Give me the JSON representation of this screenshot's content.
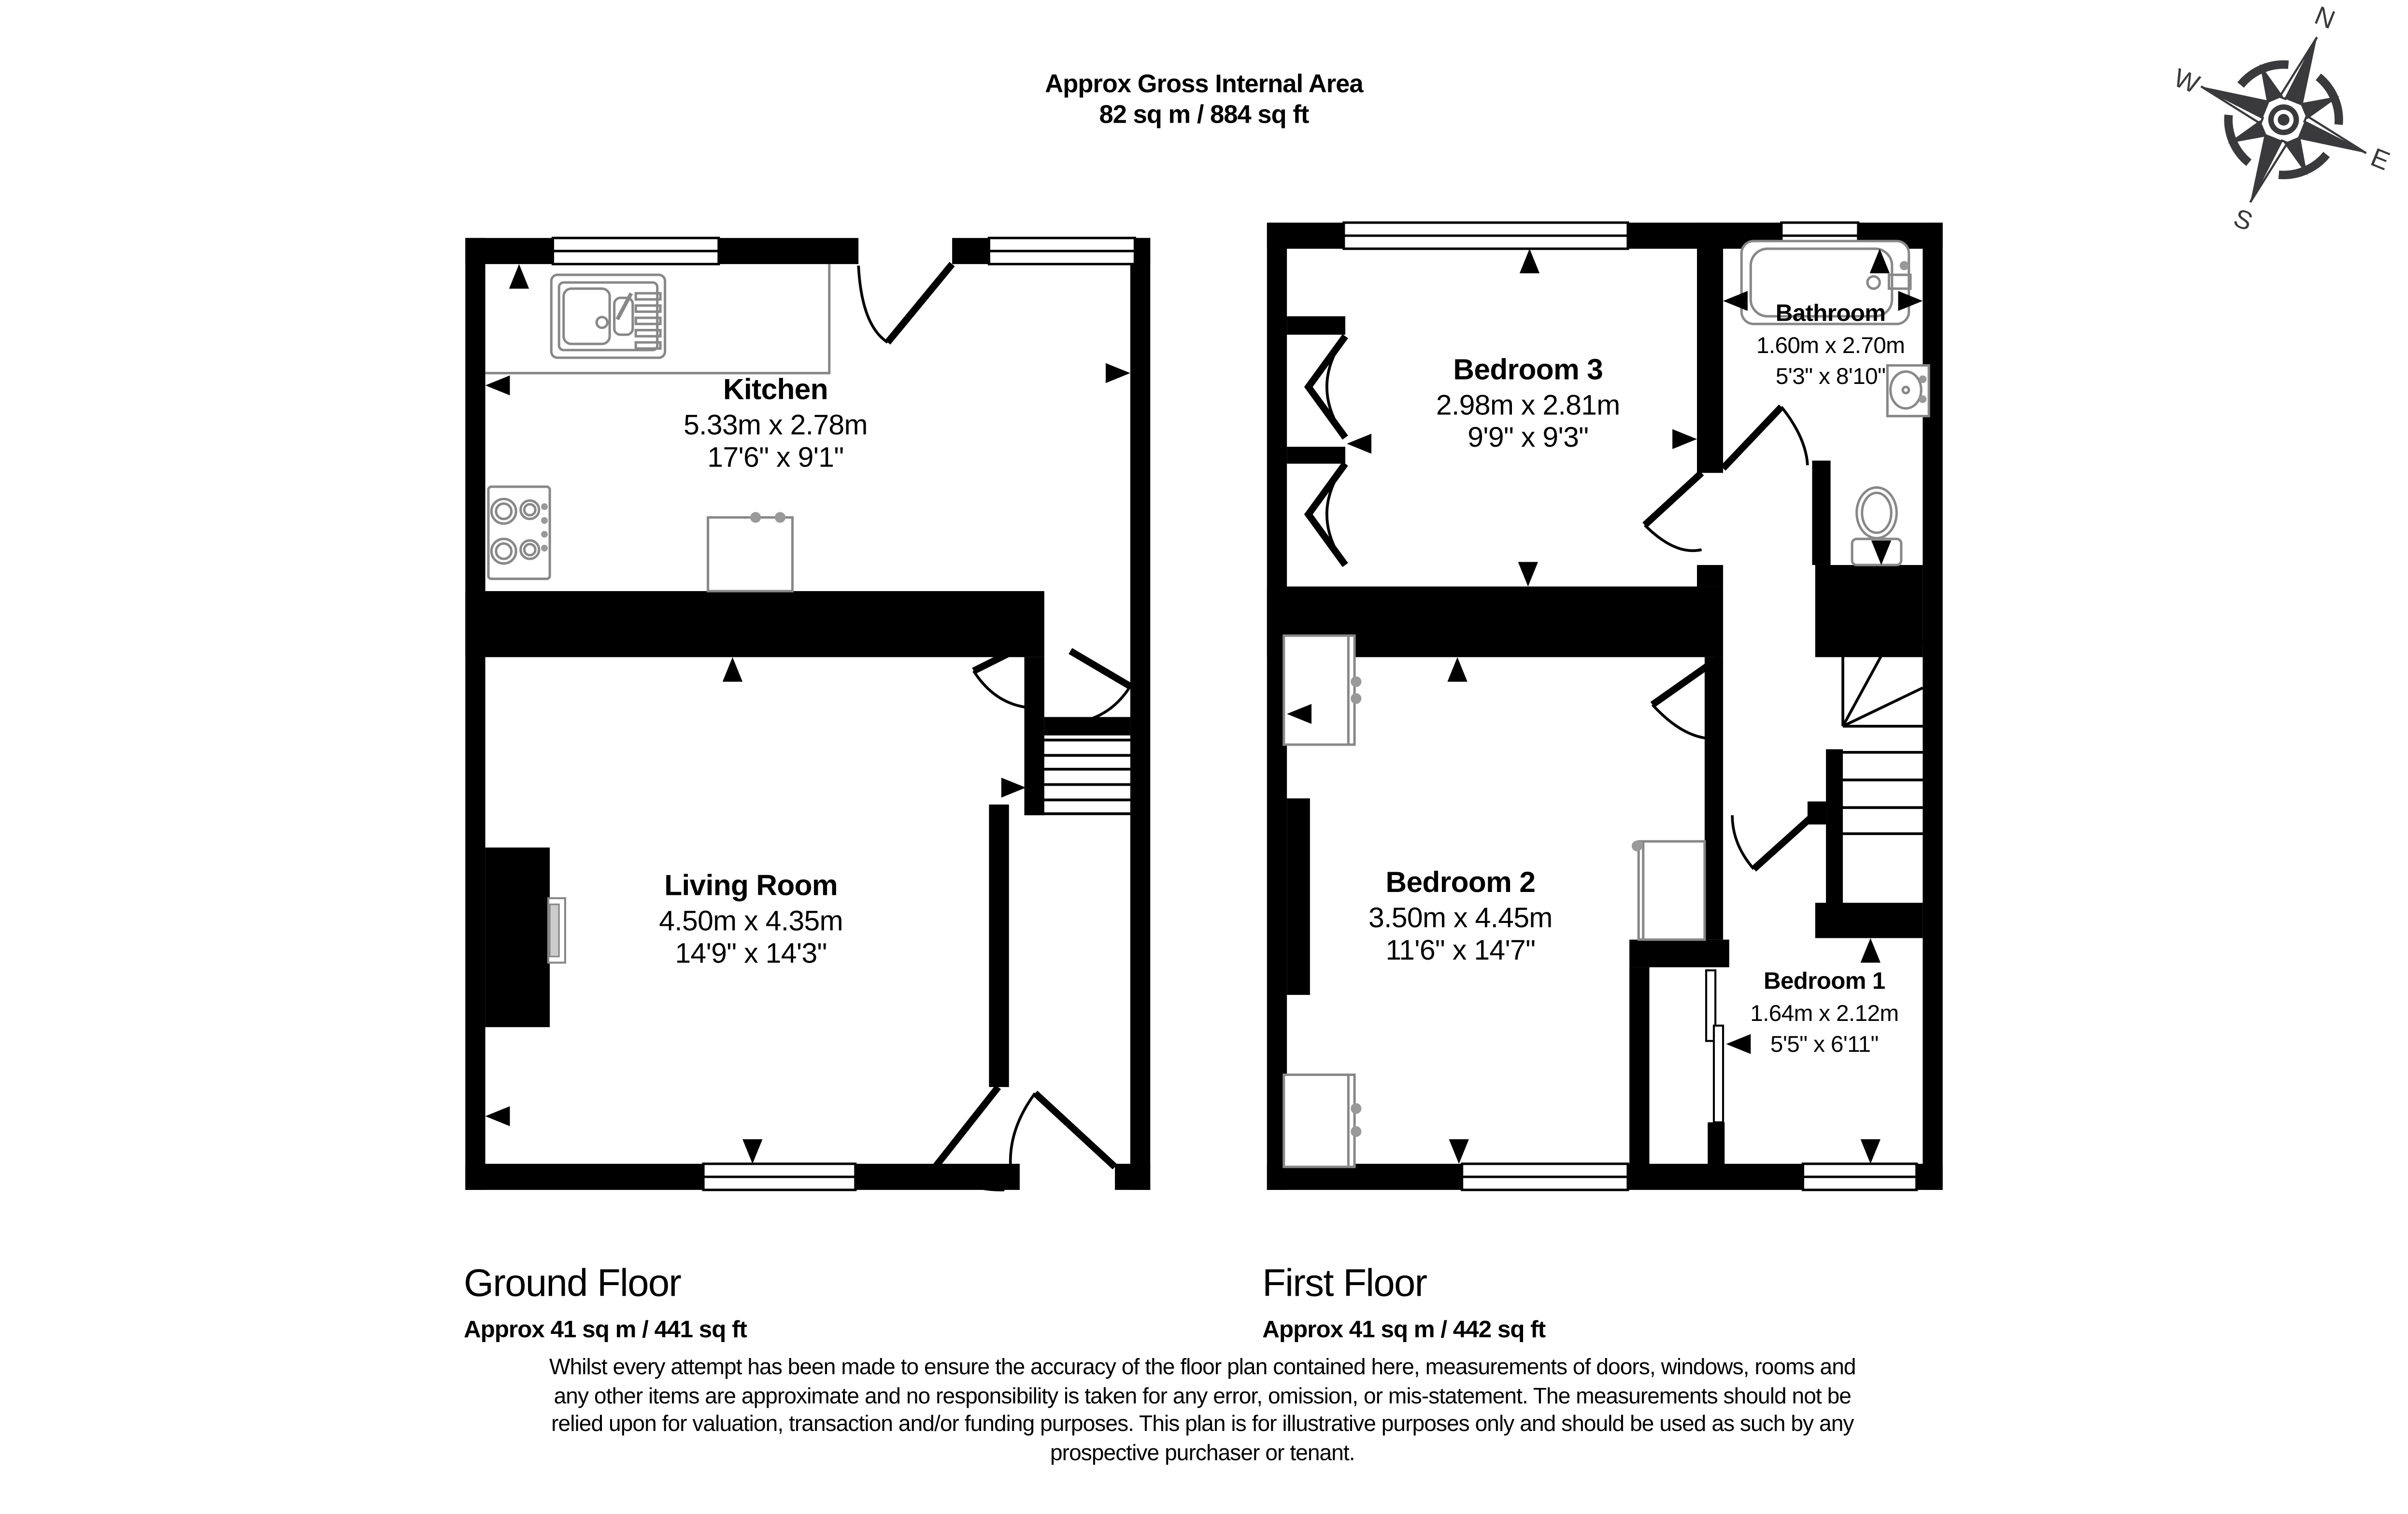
{
  "header": {
    "line1": "Approx Gross Internal Area",
    "line2": "82 sq m / 884 sq ft"
  },
  "compass": {
    "n": "N",
    "e": "E",
    "s": "S",
    "w": "W"
  },
  "rooms": [
    {
      "id": "kitchen",
      "name": "Kitchen",
      "metric": "5.33m x 2.78m",
      "imperial": "17'6\" x 9'1\""
    },
    {
      "id": "living-room",
      "name": "Living Room",
      "metric": "4.50m x 4.35m",
      "imperial": "14'9\" x 14'3\""
    },
    {
      "id": "bedroom-3",
      "name": "Bedroom 3",
      "metric": "2.98m x 2.81m",
      "imperial": "9'9\" x 9'3\""
    },
    {
      "id": "bathroom",
      "name": "Bathroom",
      "metric": "1.60m x 2.70m",
      "imperial": "5'3\" x 8'10\""
    },
    {
      "id": "bedroom-2",
      "name": "Bedroom 2",
      "metric": "3.50m x 4.45m",
      "imperial": "11'6\" x 14'7\""
    },
    {
      "id": "bedroom-1",
      "name": "Bedroom 1",
      "metric": "1.64m x 2.12m",
      "imperial": "5'5\" x 6'11\""
    }
  ],
  "floors": [
    {
      "name": "Ground Floor",
      "area": "Approx 41 sq m / 441 sq ft"
    },
    {
      "name": "First Floor",
      "area": "Approx 41 sq m / 442 sq ft"
    }
  ],
  "disclaimer": {
    "lines": [
      "Whilst every attempt has been made to ensure the accuracy of the floor plan contained here, measurements of doors, windows, rooms and",
      "any other items are approximate and no responsibility is taken for any error, omission, or mis-statement. The measurements should not be",
      "relied upon for valuation, transaction and/or funding purposes. This plan is for illustrative purposes only and should be used as such by any",
      "prospective purchaser or tenant."
    ]
  }
}
